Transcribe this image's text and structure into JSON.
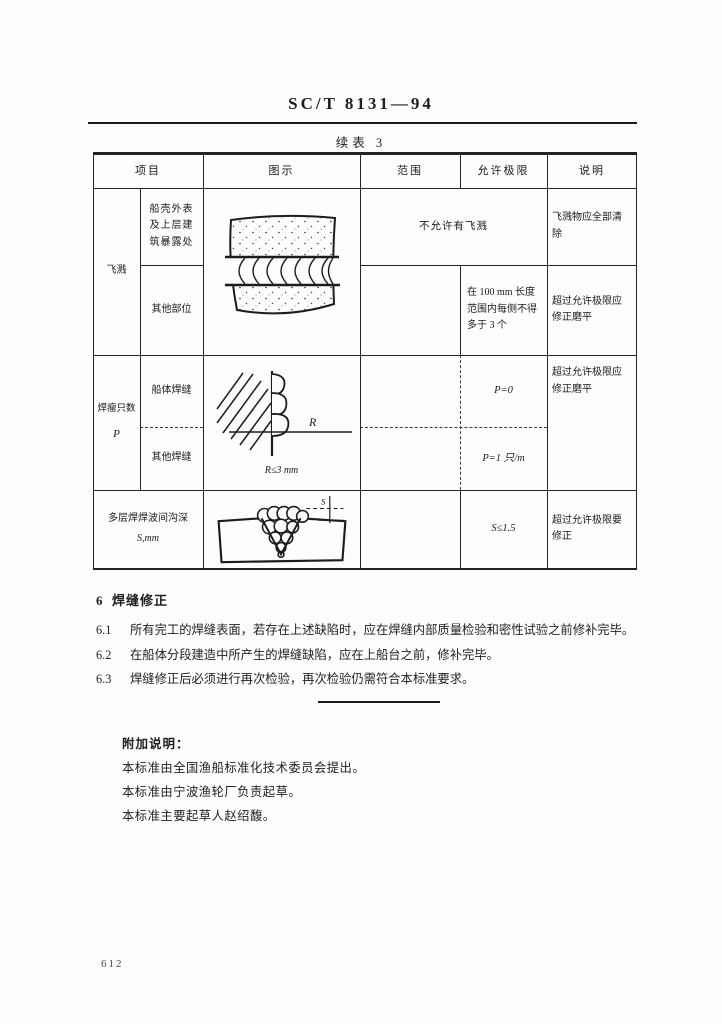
{
  "header": {
    "doc_number": "SC/T 8131—94",
    "table_caption": "续表 3"
  },
  "table": {
    "columns": [
      "项目",
      "图示",
      "范围",
      "允许极限",
      "说明"
    ],
    "spatter": {
      "group_label": "飞溅",
      "row1": {
        "item": "船壳外表及上层建筑暴露处",
        "limit": "不允许有飞溅",
        "note": "飞溅物应全部清除"
      },
      "row2": {
        "item": "其他部位",
        "limit": "在 100 mm 长度范围内每侧不得多于 3 个",
        "note": "超过允许极限应修正磨平"
      }
    },
    "overlap": {
      "group_label": "焊瘤只数",
      "group_symbol": "P",
      "row1": {
        "item": "船体焊缝",
        "limit": "P=0"
      },
      "row2": {
        "item": "其他焊缝",
        "limit": "P=1 只/m"
      },
      "note": "超过允许极限应修正磨平",
      "figure_label": "R",
      "figure_caption": "R≤3 mm"
    },
    "groove": {
      "item_line1": "多层焊焊波间沟深",
      "item_line2": "S,mm",
      "limit": "S≤1.5",
      "note": "超过允许极限要修正",
      "figure_label": "S"
    }
  },
  "section": {
    "heading_num": "6",
    "heading_text": "焊缝修正",
    "clauses": [
      {
        "num": "6.1",
        "text": "所有完工的焊缝表面，若存在上述缺陷时，应在焊缝内部质量检验和密性试验之前修补完毕。"
      },
      {
        "num": "6.2",
        "text": "在船体分段建造中所产生的焊缝缺陷，应在上船台之前，修补完毕。"
      },
      {
        "num": "6.3",
        "text": "焊缝修正后必须进行再次检验，再次检验仍需符合本标准要求。"
      }
    ]
  },
  "appendix": {
    "heading": "附加说明：",
    "lines": [
      "本标准由全国渔船标准化技术委员会提出。",
      "本标准由宁波渔轮厂负责起草。",
      "本标准主要起草人赵绍馥。"
    ]
  },
  "footer": {
    "page_number": "612"
  },
  "colors": {
    "ink": "#1f1f1f",
    "paper": "#fdfdfb"
  }
}
